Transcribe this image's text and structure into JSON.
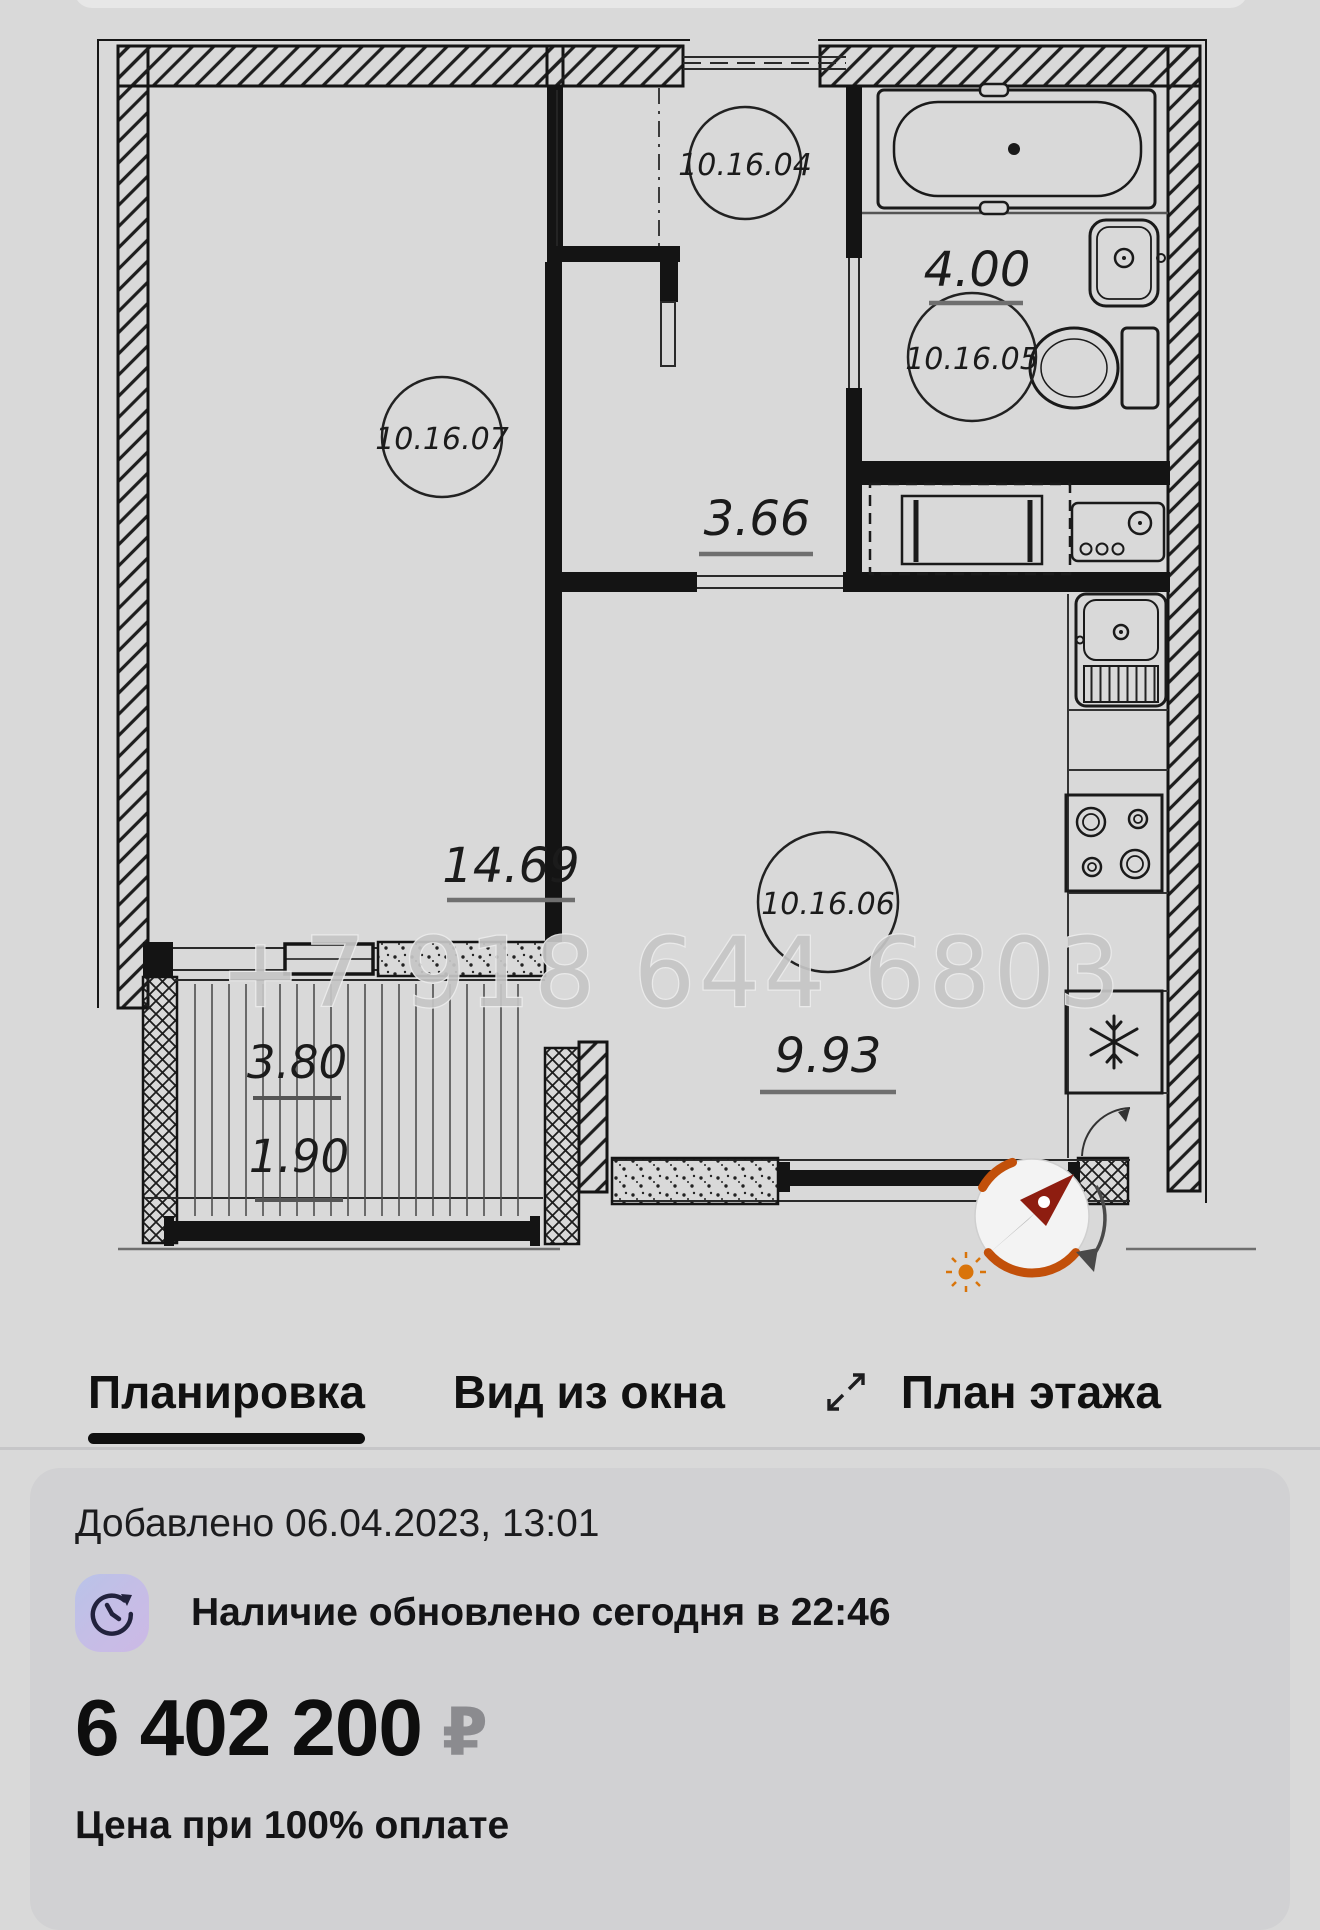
{
  "floor_plan": {
    "watermark": "+7 918 644 6803",
    "rooms": {
      "living": {
        "number": "10.16.07",
        "area": "14.69"
      },
      "hallway": {
        "number": "10.16.04",
        "area": "3.66"
      },
      "bathroom": {
        "number": "10.16.05",
        "area": "4.00"
      },
      "kitchen": {
        "number": "10.16.06",
        "area": "9.93"
      }
    },
    "balcony": {
      "area": "3.80",
      "area_reduced": "1.90"
    }
  },
  "tabs": {
    "planning": "Планировка",
    "window_view": "Вид из окна",
    "floor_plan_tab": "План этажа"
  },
  "listing": {
    "added": "Добавлено 06.04.2023, 13:01",
    "availability": "Наличие обновлено сегодня в 22:46",
    "price": "6 402 200",
    "currency": "₽",
    "price_note": "Цена при 100% оплате"
  },
  "colors": {
    "accent_orange": "#c2500a",
    "needle_red": "#8e1d10",
    "tab_underline": "#0f0f0f",
    "currency_gray": "#8b8b8f"
  }
}
